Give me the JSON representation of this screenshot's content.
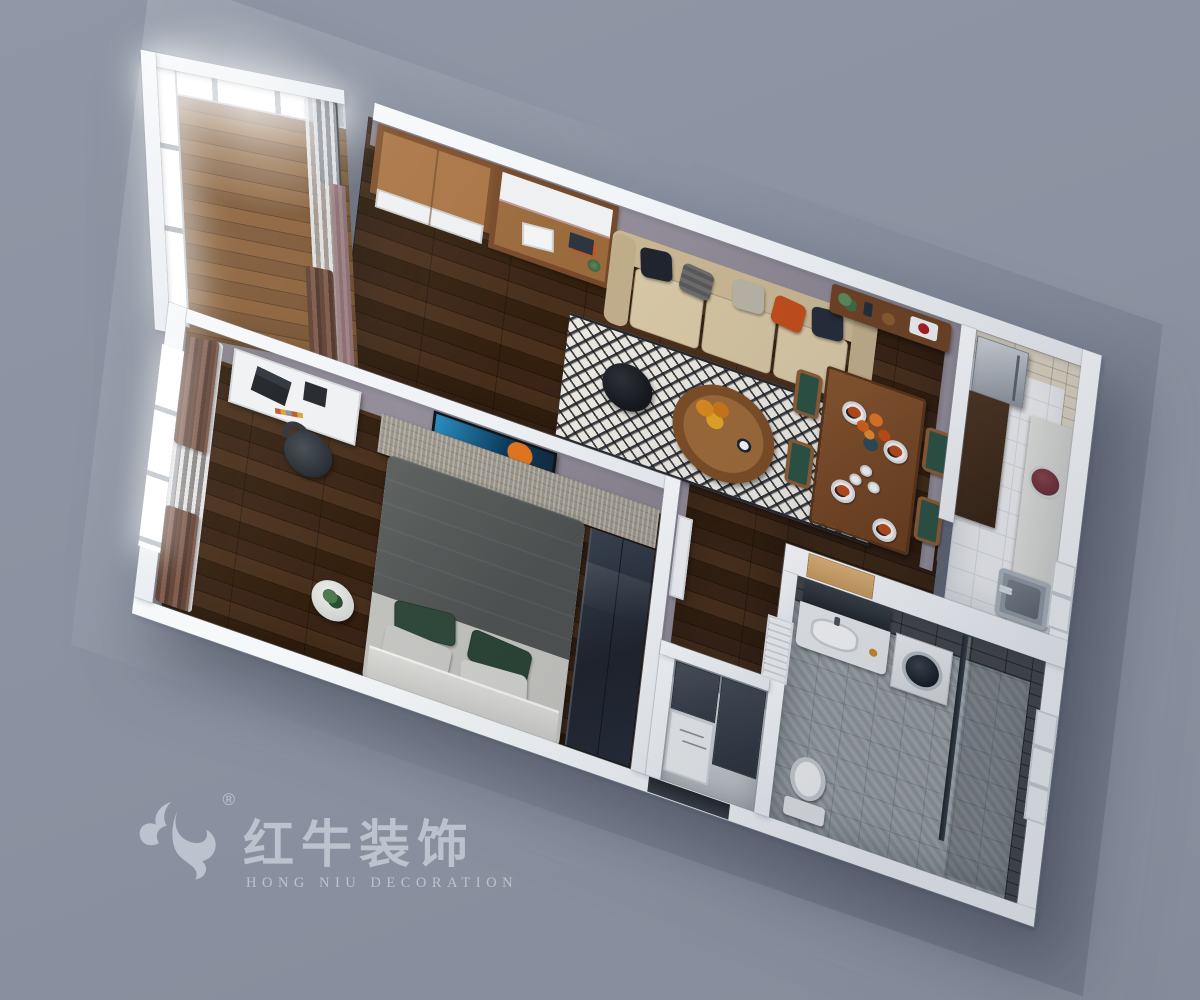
{
  "watermark": {
    "brand_cn": "红牛装饰",
    "brand_en": "HONG NIU DECORATION",
    "registered": "®",
    "icon": "bull-swoosh-icon",
    "color": "#C4CAD4"
  },
  "palette": {
    "background": "#8A92A1",
    "wall_top": "#EEF1F4",
    "interior_wall_face": "#8E8894",
    "wood_floor": "#3A2517",
    "balcony_floor": "#7A5533",
    "kitchen_floor_tile": "#ECEEF0",
    "kitchen_wall_tile": "#D9D2C1",
    "bath_floor_tile": "#99A0A4",
    "bath_wall_tile": "#44484C",
    "sofa_beige": "#D8C8A6",
    "rug_white": "#ECE9E2",
    "rug_gray": "#9A958A",
    "accent_orange": "#C4561E",
    "dining_chair_green": "#2D5244",
    "curtain_brown": "#5F4133",
    "wardrobe_navy": "#2B3340",
    "bed_blanket": "#585C5B",
    "pillow_green": "#31493C",
    "appliance_steel": "#B9BEC6"
  }
}
